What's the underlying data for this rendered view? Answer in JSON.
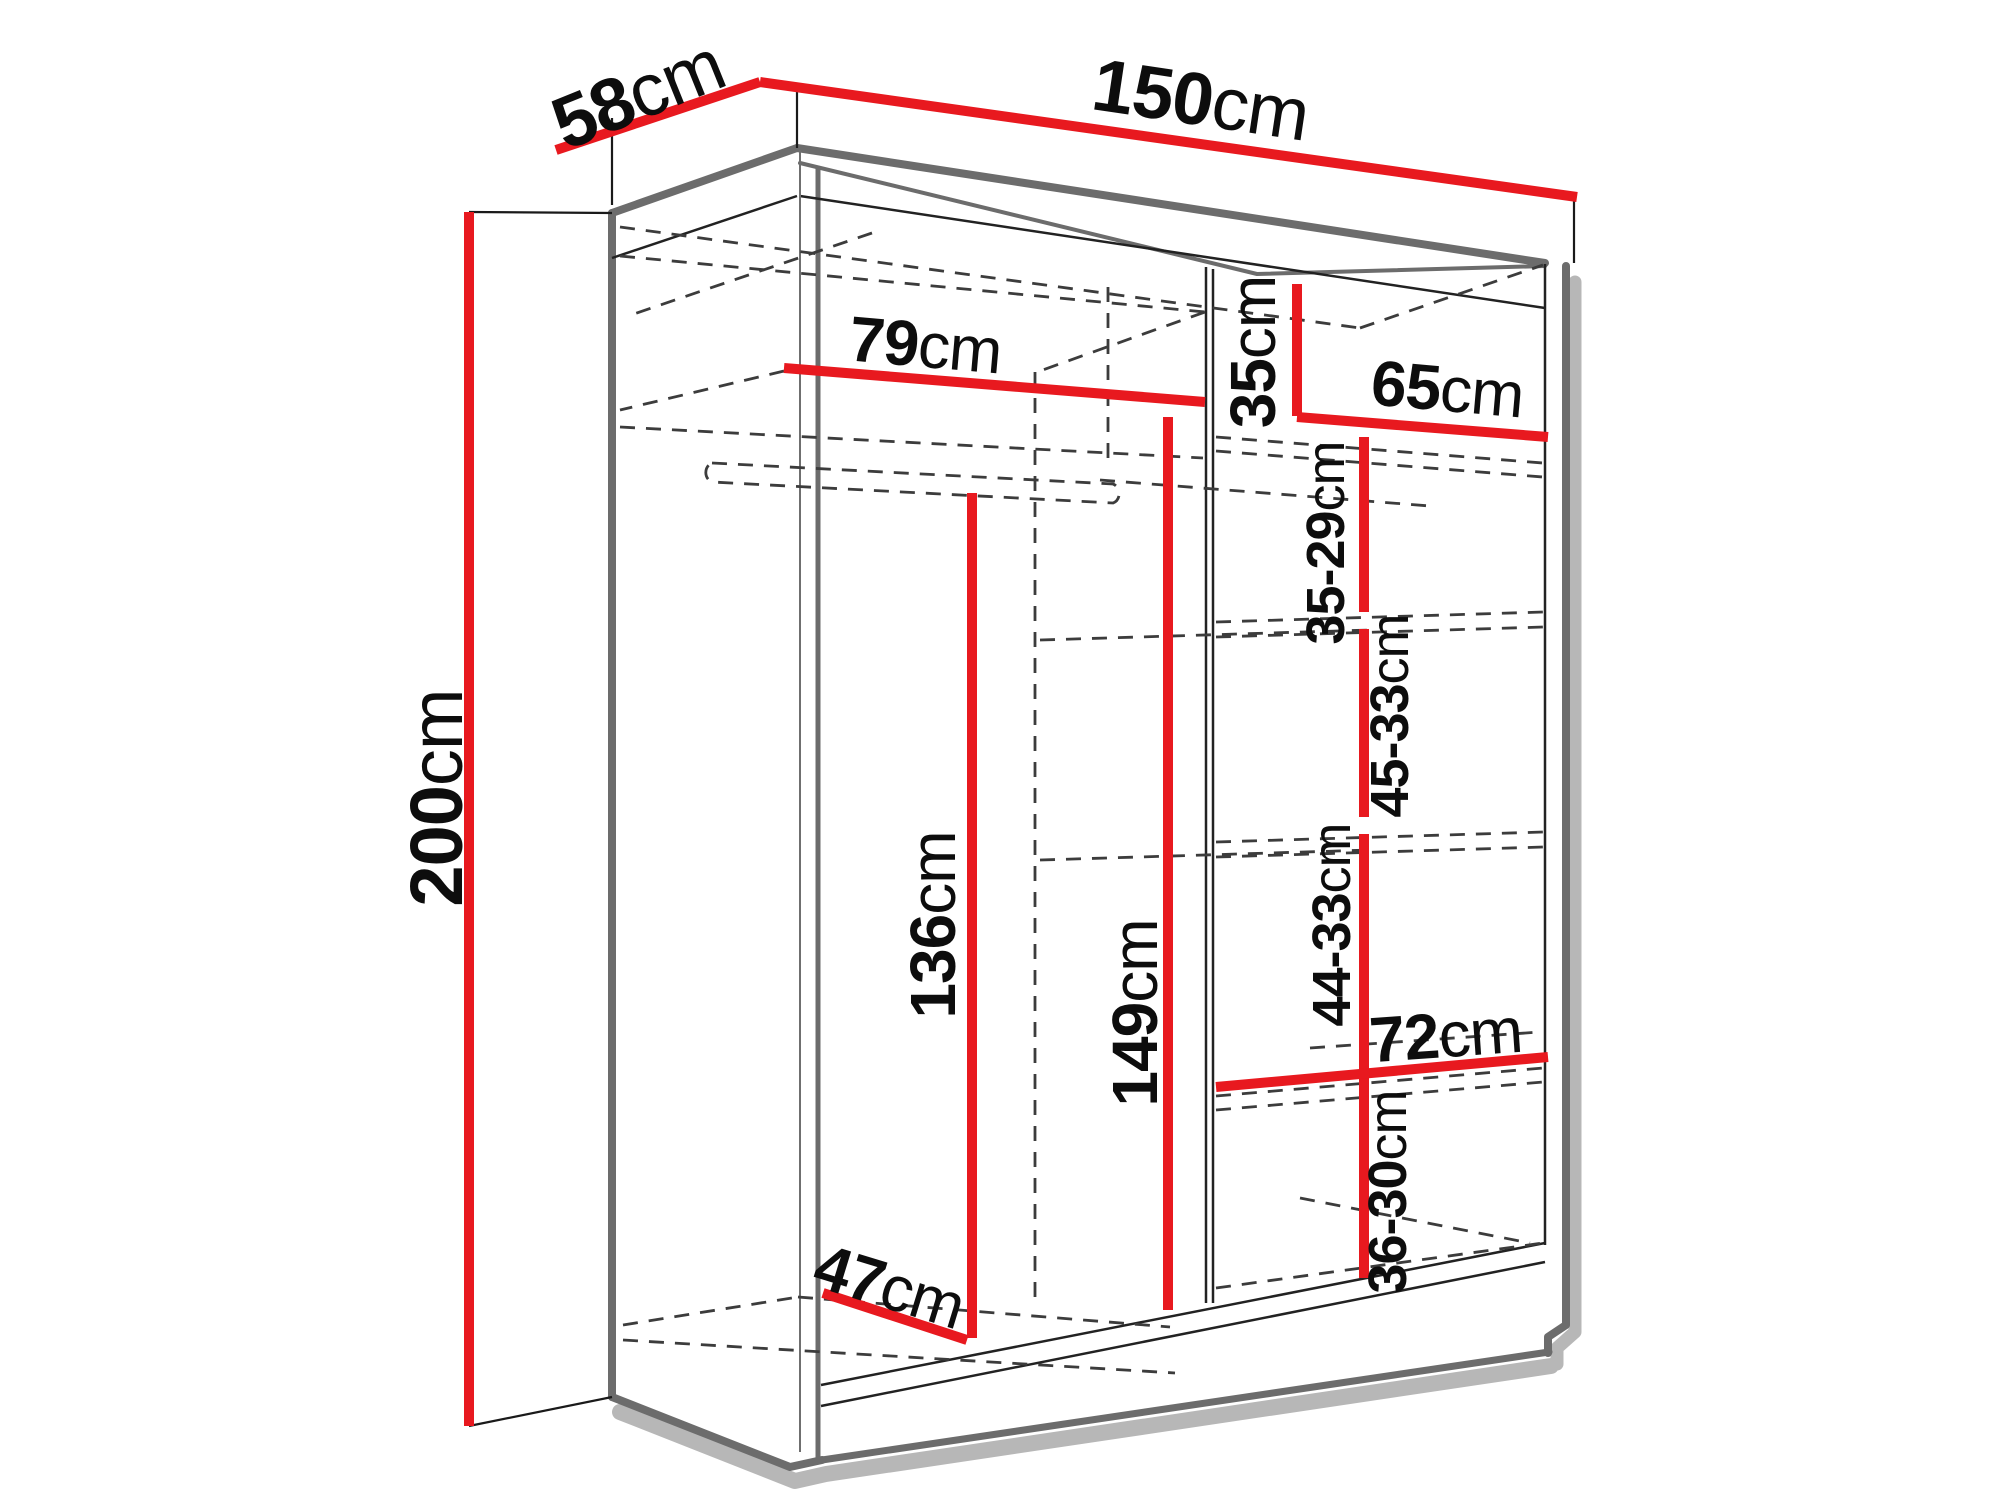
{
  "diagram": {
    "subject": "wardrobe dimension diagram",
    "unit": "cm",
    "colors": {
      "dimension_line": "#e8191f",
      "outline": "#6c6c6c",
      "hidden_edge": "#3c3c3c",
      "shadow": "#b7b7b7",
      "text": "#0d0d0d",
      "background": "#ffffff"
    }
  },
  "labels": {
    "width": {
      "value": "150",
      "unit": "cm"
    },
    "depth": {
      "value": "58",
      "unit": "cm"
    },
    "height": {
      "value": "200",
      "unit": "cm"
    },
    "left_top_shelf_width": {
      "value": "79",
      "unit": "cm"
    },
    "right_top_cubby_height": {
      "value": "35",
      "unit": "cm"
    },
    "right_top_shelf_width": {
      "value": "65",
      "unit": "cm"
    },
    "right_cubby_height_1": {
      "value": "35-29",
      "unit": "cm"
    },
    "right_cubby_height_2": {
      "value": "45-33",
      "unit": "cm"
    },
    "hanging_space_height": {
      "value": "136",
      "unit": "cm"
    },
    "left_section_height": {
      "value": "149",
      "unit": "cm"
    },
    "right_cubby_height_3": {
      "value": "44-33",
      "unit": "cm"
    },
    "right_bottom_shelf_width": {
      "value": "72",
      "unit": "cm"
    },
    "right_cubby_height_4": {
      "value": "36-30",
      "unit": "cm"
    },
    "floor_depth": {
      "value": "47",
      "unit": "cm"
    }
  }
}
